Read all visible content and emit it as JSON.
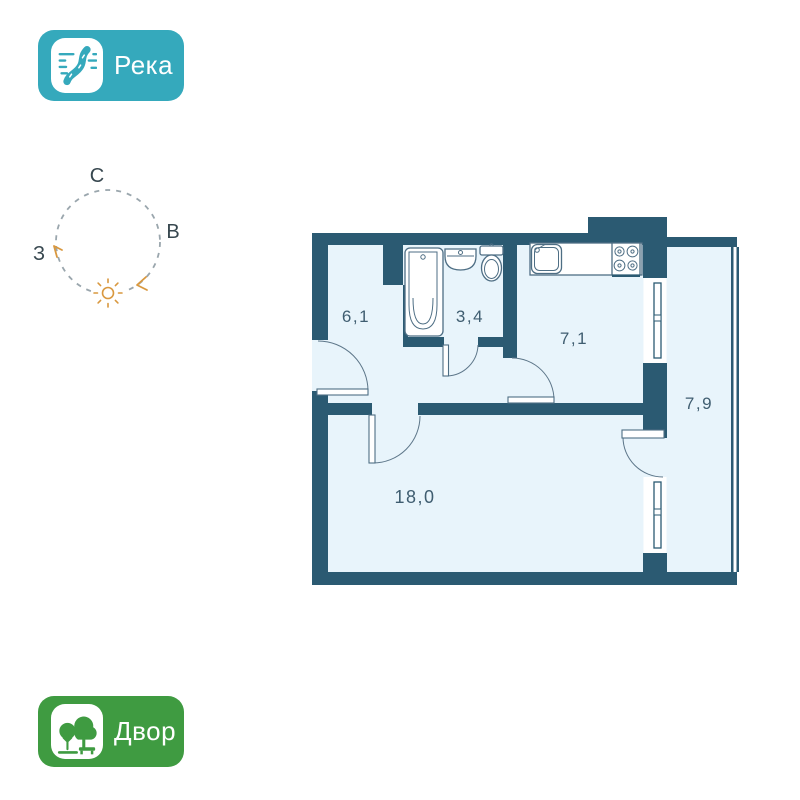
{
  "colors": {
    "wall": "#2b5a72",
    "floor": "#e8f4fb",
    "fixture-line": "#4e6e84",
    "door-line": "#5d7689",
    "room-label": "#3f5d70",
    "river-badge": "#35a9bc",
    "yard-badge": "#3f9b41",
    "compass-letter": "#37474f",
    "compass-circle": "#9aa6ad",
    "sun": "#d9983f",
    "badge-text": "#ffffff"
  },
  "badges": {
    "river": {
      "label": "Река"
    },
    "yard": {
      "label": "Двор"
    }
  },
  "compass": {
    "north": "С",
    "east": "В",
    "west": "З"
  },
  "floorplan": {
    "rooms": [
      {
        "name": "hallway",
        "area": "6,1"
      },
      {
        "name": "bathroom",
        "area": "3,4"
      },
      {
        "name": "kitchen",
        "area": "7,1"
      },
      {
        "name": "balcony",
        "area": "7,9"
      },
      {
        "name": "living-room",
        "area": "18,0"
      }
    ]
  }
}
